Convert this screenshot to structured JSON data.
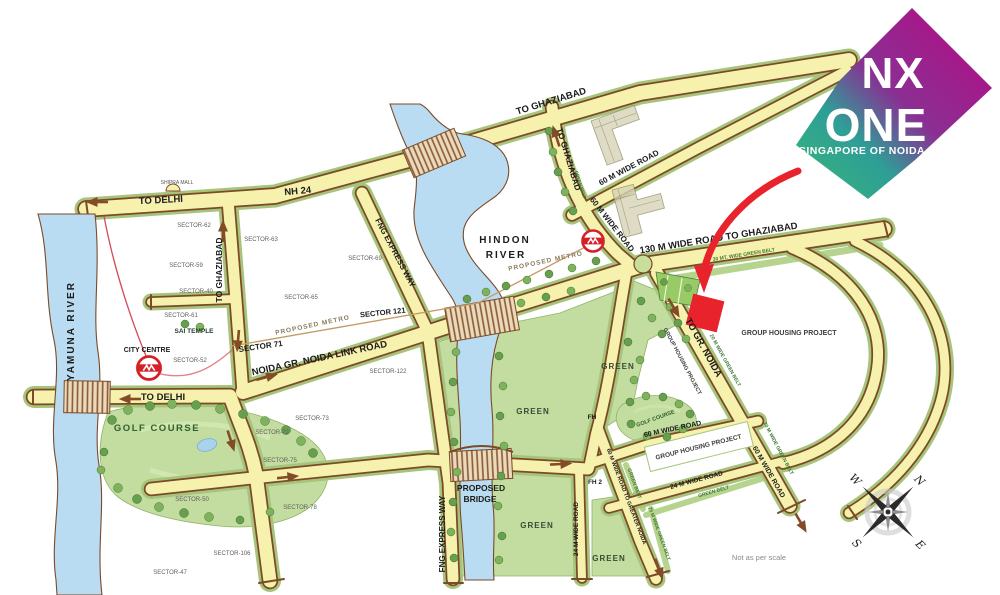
{
  "logo": {
    "nx": "NX",
    "one": "ONE",
    "tagline": "SINGAPORE OF NOIDA"
  },
  "labels": {
    "to_ghaziabad": "TO GHAZIABAD",
    "nh24": "NH 24",
    "to_delhi": "TO DELHI",
    "shipra_mall": "SHIPRA MALL",
    "road_60": "60 M WIDE ROAD",
    "road_130": "130 M WIDE ROAD TO GHAZIABAD",
    "road_24": "24 M WIDE ROAD",
    "road_60_greater": "60 M WIDE ROAD TO GREATER NOIDA",
    "link_road": "NOIDA GR. NOIDA LINK ROAD",
    "proposed_metro": "PROPOSED METRO",
    "fng": "FNG EXPRESS WAY",
    "to_gr_noida": "TO GR. NOIDA",
    "yamuna": "YAMUNA RIVER",
    "hindon_1": "HINDON",
    "hindon_2": "RIVER",
    "city_centre": "CITY CENTRE",
    "sai_temple": "SAI TEMPLE",
    "golf_course": "GOLF COURSE",
    "proposed_1": "PROPOSED",
    "proposed_2": "BRIDGE",
    "green": "GREEN",
    "fh": "FH",
    "fh2": "FH 2",
    "group_housing": "GROUP HOUSING PROJECT",
    "green_belt": "GREEN BELT",
    "green_belt_20": "20 M WIDE GREEN BELT",
    "green_belt_30": "30 MT. WIDE GREEN BELT",
    "green_belt_75": "75 M WIDE GREEN BELT",
    "sector_71": "SECTOR 71",
    "sector_121": "SECTOR 121",
    "not_scale": "Not as per scale"
  },
  "sectors": [
    {
      "label": "SECTOR-62"
    },
    {
      "label": "SECTOR-63"
    },
    {
      "label": "SECTOR-59"
    },
    {
      "label": "SECTOR-40"
    },
    {
      "label": "SECTOR-61"
    },
    {
      "label": "SECTOR-52"
    },
    {
      "label": "SECTOR-65"
    },
    {
      "label": "SECTOR-69"
    },
    {
      "label": "SECTOR-122"
    },
    {
      "label": "SECTOR-73"
    },
    {
      "label": "SECTOR-72"
    },
    {
      "label": "SECTOR-75"
    },
    {
      "label": "SECTOR-78"
    },
    {
      "label": "SECTOR-106"
    },
    {
      "label": "SECTOR-47"
    },
    {
      "label": "SECTOR-50"
    }
  ],
  "compass": {
    "n": "N",
    "e": "E",
    "s": "S",
    "w": "W"
  },
  "colors": {
    "road_fill": "#f6f1ac",
    "road_border": "#7b4a28",
    "green_edge": "#a7c47b",
    "green_zone": "#c3dc9f",
    "river_blue": "#b9dcf2",
    "site_red": "#e8232b",
    "metro_red": "#d42027",
    "logo_magenta": "#ae1287",
    "logo_teal": "#35b07e"
  }
}
